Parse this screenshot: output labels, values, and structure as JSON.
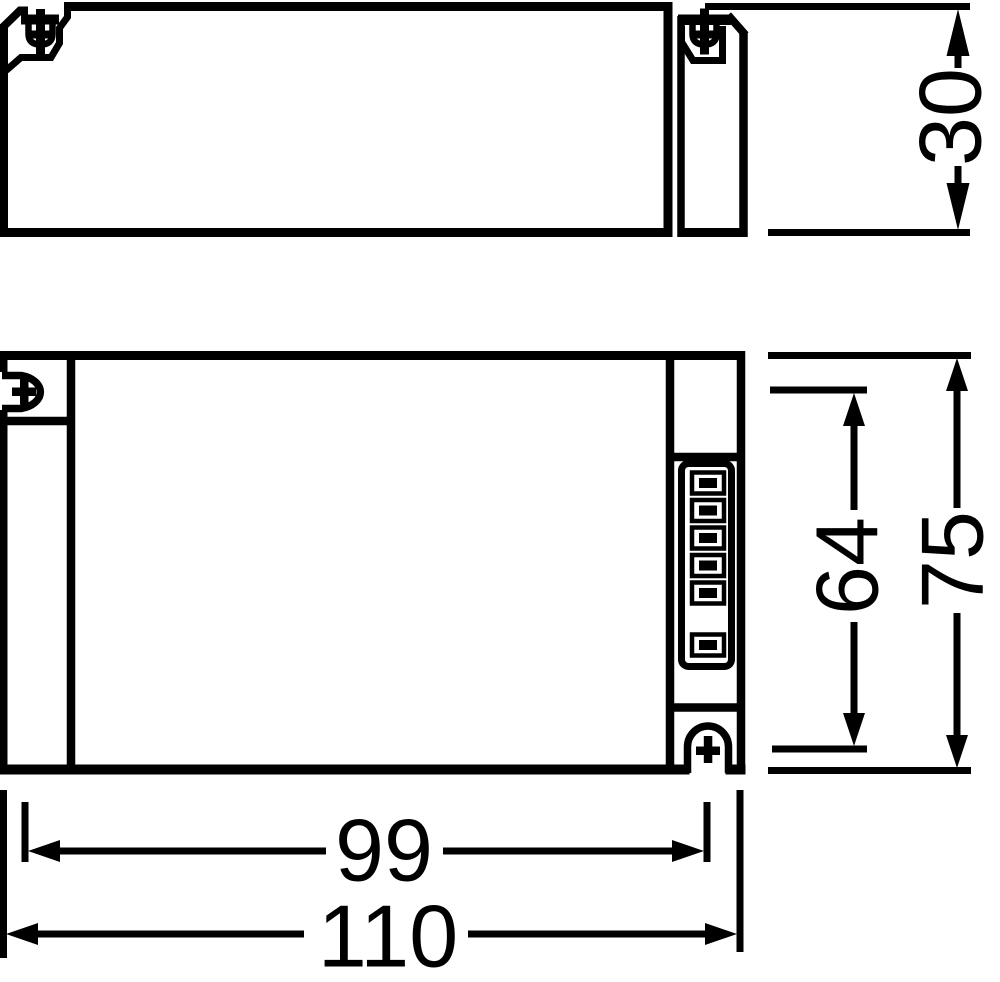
{
  "drawing": {
    "background_color": "#ffffff",
    "line_color": "#000000",
    "dimension_labels": {
      "height_side_view": "30",
      "mounting_pitch_transverse": "64",
      "overall_width": "75",
      "mounting_pitch_longitudinal": "99",
      "overall_length": "110"
    },
    "terminal_block": {
      "slot_count": 7,
      "filled_slot_count": 6
    }
  }
}
